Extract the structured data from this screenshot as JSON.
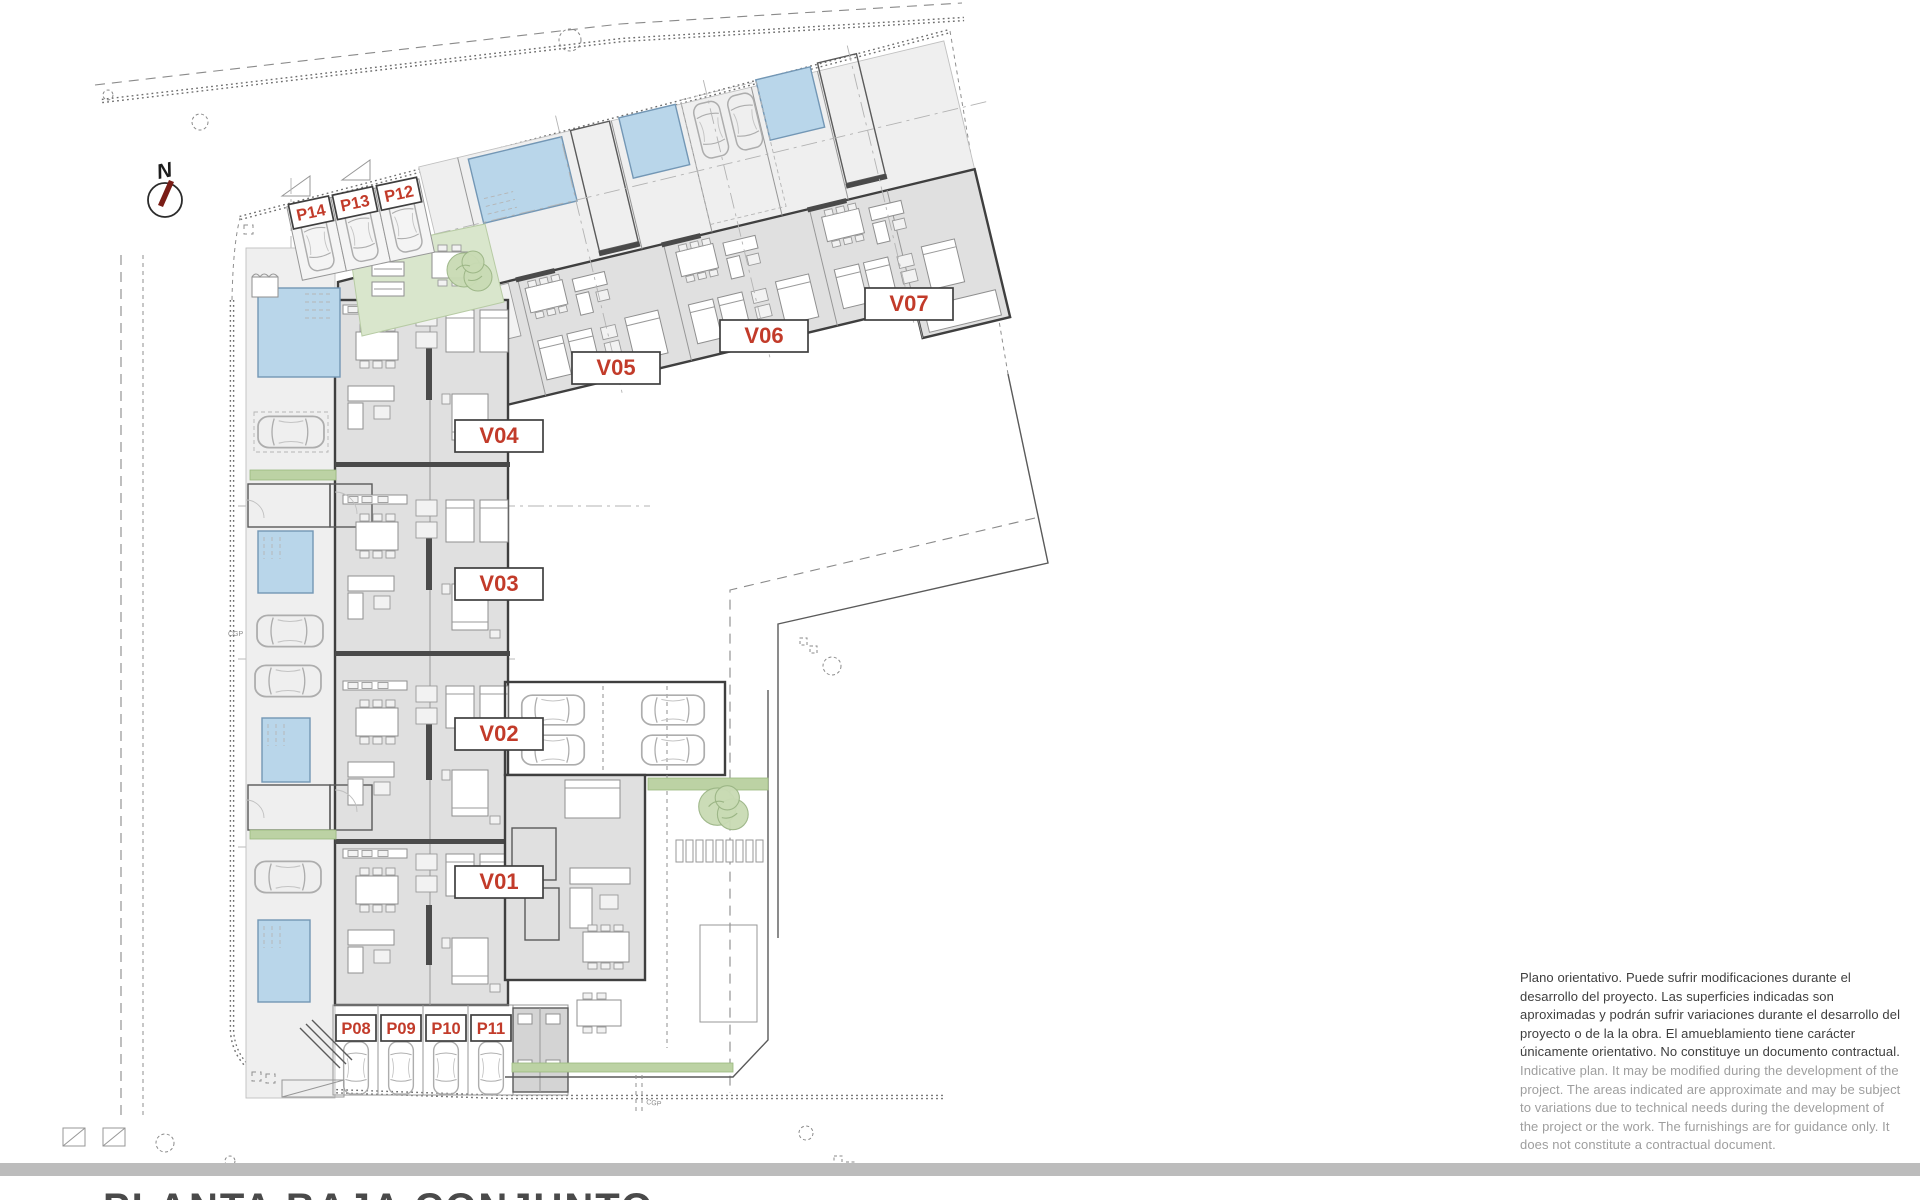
{
  "sheet": {
    "title": "PLANTA BAJA CONJUNTO"
  },
  "compass": {
    "north_label": "N"
  },
  "units": [
    {
      "label": "V01"
    },
    {
      "label": "V02"
    },
    {
      "label": "V03"
    },
    {
      "label": "V04"
    },
    {
      "label": "V05"
    },
    {
      "label": "V06"
    },
    {
      "label": "V07"
    }
  ],
  "parking": [
    {
      "label": "P08"
    },
    {
      "label": "P09"
    },
    {
      "label": "P10"
    },
    {
      "label": "P11"
    },
    {
      "label": "P12"
    },
    {
      "label": "P13"
    },
    {
      "label": "P14"
    }
  ],
  "utilities": {
    "cgp": "CGP"
  },
  "disclaimer": {
    "es": "Plano orientativo. Puede sufrir modificaciones durante el desarrollo del proyecto. Las superficies indicadas son aproximadas y podrán sufrir variaciones durante el desarrollo del proyecto o de la la obra. El amueblamiento tiene carácter únicamente orientativo. No constituye un documento contractual.",
    "en": "Indicative plan. It may be modified during the development of the project. The areas indicated are approximate and may be subject to variations due to technical needs during the development of the project or the work. The furnishings are for guidance only. It does not constitute a contractual document."
  },
  "colors": {
    "pool": "#b9d6ea",
    "lawn": "#d9e6cc",
    "label_red": "#c23b2a",
    "scrollbar": "#bcbcbc"
  }
}
